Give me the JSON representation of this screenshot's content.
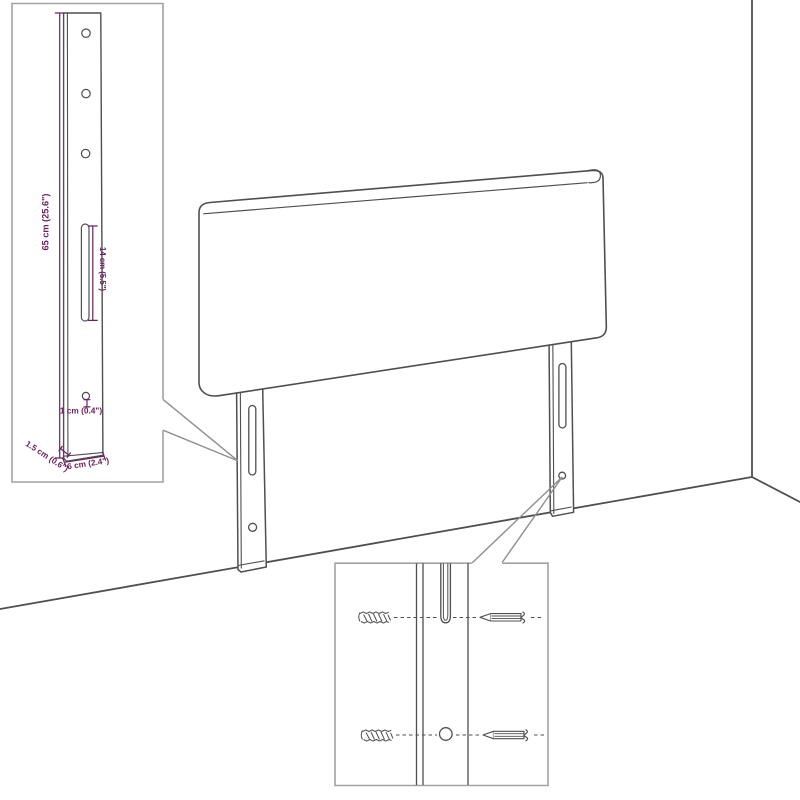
{
  "colors": {
    "line": "#4f4f4f",
    "inset_border": "#a2a2a2",
    "callout_line": "#8f8f8f",
    "dimension": "#6b2161",
    "background": "#ffffff"
  },
  "insets": {
    "bracket_detail": {
      "labels": {
        "height": "65 cm (25.6\")",
        "slot_height": "14 cm (5.5\")",
        "hole_offset": "1 cm (0.4\")",
        "thickness": "1.5 cm (0.6\")",
        "width": "6 cm (2.4\")"
      }
    }
  }
}
